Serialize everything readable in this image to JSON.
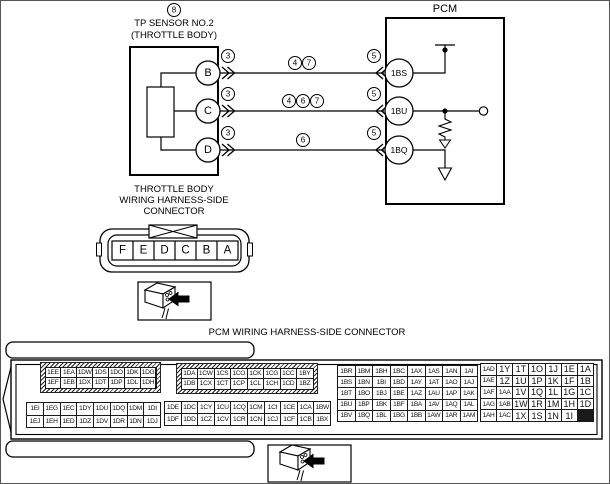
{
  "icons": {
    "instruction_box": "connector-with-arrow-icon",
    "splice_out": "double-chevron-right-icon",
    "splice_in": "double-chevron-left-icon",
    "power": "power-node-icon",
    "resistor": "resistor-icon",
    "ground": "ground-arrow-icon"
  },
  "colors": {
    "line": "#000000",
    "background": "#ffffff"
  },
  "sensor": {
    "ref": "8",
    "title_line1": "TP SENSOR NO.2",
    "title_line2": "(THROTTLE BODY)"
  },
  "pcm": {
    "title": "PCM"
  },
  "wires": [
    {
      "from": "B",
      "to": "1BS",
      "from_ref": "3",
      "mid_refs": [
        "4",
        "7"
      ],
      "to_ref": "5"
    },
    {
      "from": "C",
      "to": "1BU",
      "from_ref": "3",
      "mid_refs": [
        "4",
        "6",
        "7"
      ],
      "to_ref": "5"
    },
    {
      "from": "D",
      "to": "1BQ",
      "from_ref": "3",
      "mid_refs": [
        "6"
      ],
      "to_ref": "5"
    }
  ],
  "throttle_connector": {
    "label_line1": "THROTTLE BODY",
    "label_line2": "WIRING HARNESS-SIDE",
    "label_line3": "CONNECTOR",
    "pins": [
      "F",
      "E",
      "D",
      "C",
      "B",
      "A"
    ]
  },
  "pcm_connector": {
    "title": "PCM WIRING HARNESS-SIDE CONNECTOR",
    "blocks": [
      {
        "style": "hatched",
        "rows": [
          [
            "1EE",
            "1EA",
            "1DW",
            "1DS",
            "1DO",
            "1DK",
            "1DG"
          ],
          [
            "1EF",
            "1EB",
            "1DX",
            "1DT",
            "1DP",
            "1DL",
            "1DH"
          ]
        ]
      },
      {
        "style": "hatched",
        "rows": [
          [
            "1DA",
            "1CW",
            "1CS",
            "1CO",
            "1CK",
            "1CG",
            "1CC",
            "1BY"
          ],
          [
            "1DB",
            "1CX",
            "1CT",
            "1CP",
            "1CL",
            "1CH",
            "1CD",
            "1BZ"
          ]
        ]
      },
      {
        "style": "plain",
        "rows": [
          [
            "1EI",
            "1EG",
            "1EC",
            "1DY",
            "1DU",
            "1DQ",
            "1DM",
            "1DI"
          ],
          [
            "1EJ",
            "1EH",
            "1ED",
            "1DZ",
            "1DV",
            "1DR",
            "1DN",
            "1DJ"
          ]
        ]
      },
      {
        "style": "plain",
        "rows": [
          [
            "1DE",
            "1DC",
            "1CY",
            "1CU",
            "1CQ",
            "1CM",
            "1CI",
            "1CE",
            "1CA",
            "1BW"
          ],
          [
            "1DF",
            "1DD",
            "1CZ",
            "1CV",
            "1CR",
            "1CN",
            "1CJ",
            "1CF",
            "1CB",
            "1BX"
          ]
        ]
      },
      {
        "style": "plain",
        "rows": [
          [
            "1BR",
            "1BM",
            "1BH",
            "1BC",
            "1AX",
            "1AS",
            "1AN",
            "1AI"
          ],
          [
            "1BS",
            "1BN",
            "1BI",
            "1BD",
            "1AY",
            "1AT",
            "1AO",
            "1AJ"
          ],
          [
            "1BT",
            "1BO",
            "1BJ",
            "1BE",
            "1AZ",
            "1AU",
            "1AP",
            "1AK"
          ],
          [
            "1BU",
            "1BP",
            "1BK",
            "1BF",
            "1BA",
            "1AV",
            "1AQ",
            "1AL"
          ],
          [
            "1BV",
            "1BQ",
            "1BL",
            "1BG",
            "1BB",
            "1AW",
            "1AR",
            "1AM"
          ]
        ]
      },
      {
        "style": "plain",
        "rows": [
          [
            "1AD",
            "1Y",
            "1T",
            "1O",
            "1J",
            "1E",
            "1A"
          ],
          [
            "1AE",
            "1Z",
            "1U",
            "1P",
            "1K",
            "1F",
            "1B"
          ],
          [
            "1AF",
            "1AA",
            "1V",
            "1Q",
            "1L",
            "1G",
            "1C"
          ],
          [
            "1AG",
            "1AB",
            "1W",
            "1R",
            "1M",
            "1H",
            "1D"
          ],
          [
            "1AH",
            "1AC",
            "1X",
            "1S",
            "1N",
            "1I"
          ]
        ]
      }
    ]
  }
}
